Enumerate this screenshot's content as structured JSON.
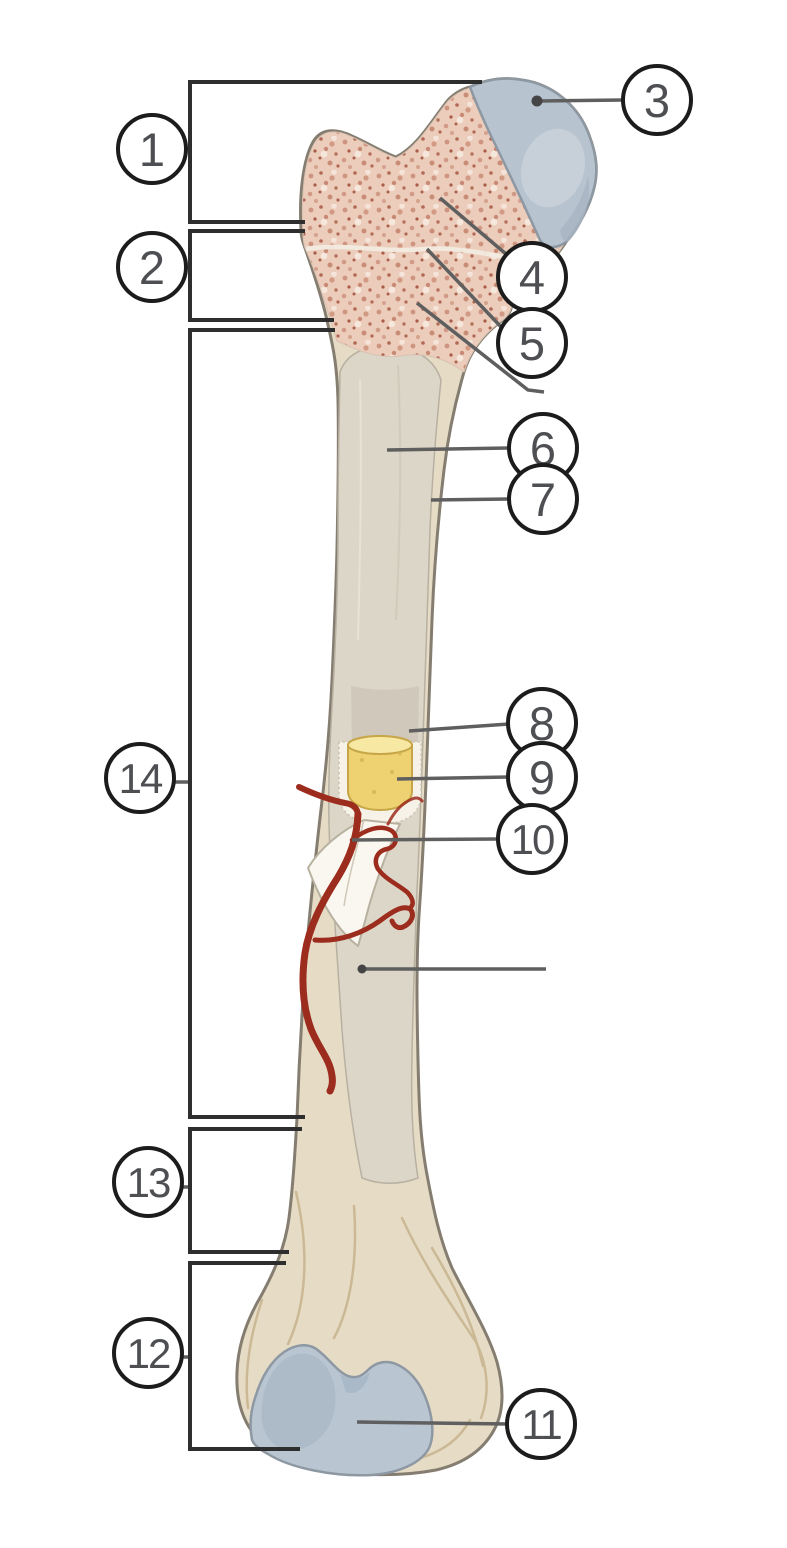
{
  "figure": {
    "title": "long bone anatomy labeling diagram",
    "type": "labeled-diagram",
    "labels": [
      {
        "id": "1",
        "text": "1",
        "x": 152,
        "y": 149
      },
      {
        "id": "2",
        "text": "2",
        "x": 152,
        "y": 267
      },
      {
        "id": "3",
        "text": "3",
        "x": 657,
        "y": 100
      },
      {
        "id": "4",
        "text": "4",
        "x": 532,
        "y": 277
      },
      {
        "id": "5",
        "text": "5",
        "x": 532,
        "y": 343
      },
      {
        "id": "6",
        "text": "6",
        "x": 543,
        "y": 448
      },
      {
        "id": "7",
        "text": "7",
        "x": 543,
        "y": 499
      },
      {
        "id": "8",
        "text": "8",
        "x": 542,
        "y": 723
      },
      {
        "id": "9",
        "text": "9",
        "x": 542,
        "y": 777
      },
      {
        "id": "10",
        "text": "10",
        "x": 532,
        "y": 839
      },
      {
        "id": "11",
        "text": "11",
        "x": 541,
        "y": 1424
      },
      {
        "id": "12",
        "text": "12",
        "x": 148,
        "y": 1353
      },
      {
        "id": "13",
        "text": "13",
        "x": 148,
        "y": 1182
      },
      {
        "id": "14",
        "text": "14",
        "x": 140,
        "y": 778
      }
    ],
    "colors": {
      "background": "#ffffff",
      "articular_cartilage": "#b7c3cf",
      "spongy_bone": "#ecccbb",
      "bone_surface": "#e6dcc6",
      "medullary_cavity": "#cec7b8",
      "yellow_marrow": "#eed271",
      "nutrient_artery": "#9c2c1d",
      "label_circle_stroke": "#1c1c1c",
      "label_text": "#4d4f52",
      "leader_line": "#5f5f5f",
      "bracket_line": "#2e2e2e"
    }
  }
}
